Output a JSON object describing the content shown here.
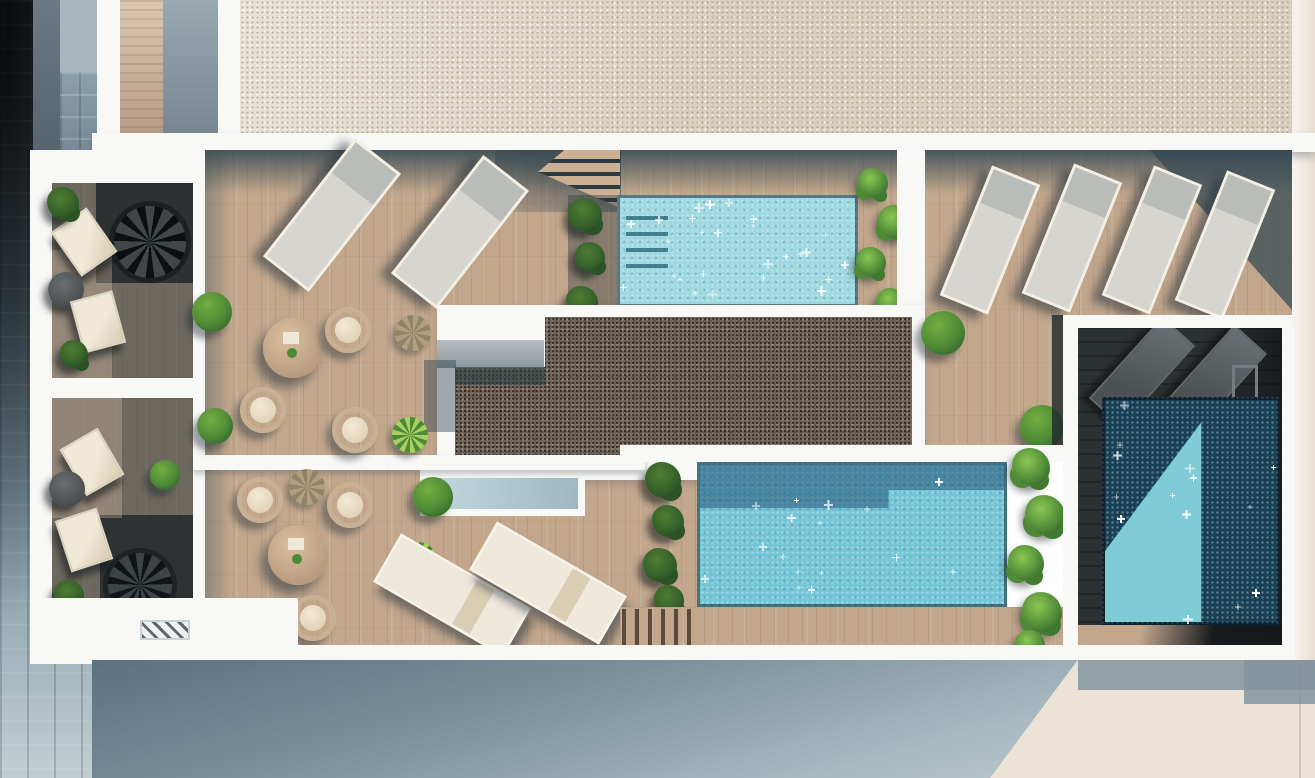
{
  "scene": {
    "type": "aerial-architectural-render",
    "subject": "Rooftop terrace of an apartment building with three swimming pools, wooden decks, sun loungers, lounge alcoves and planting",
    "lighting": "sunny day, hard diagonal shadows cast toward lower-left"
  },
  "palette": {
    "white_wall": "#f8f8f6",
    "gravel_light": "#d9d0c0",
    "gravel_dark": "#6f645a",
    "wood": "#c2a78d",
    "slate_shadow": "#44575f",
    "deck_shadow_dark": "#2c3134",
    "street_dark": "#23282d",
    "street_light": "#c2ced2",
    "facade_top": "#5b7181",
    "facade_bottom": "#c6d1d3",
    "concrete_plaza": "#ebe3d6",
    "plaza_shadow": "#a2b2bc",
    "pool_light": "#9ed8e0",
    "pool_mid": "#74c6d6",
    "pool_shadow_band": "#2f6e96",
    "pool_dark": "#173f55",
    "pool_lit_triangle": "#7fccd6",
    "lounger_gray": "#d6d5d0",
    "frame_white": "#f3efe5",
    "cream": "#ebe5d5",
    "wicker": "#c8b193",
    "plant_bright": "#74ad41",
    "plant_mid": "#4d8a36",
    "plant_dark": "#2d5a28"
  },
  "pools": [
    {
      "name": "top-pool",
      "x": 617,
      "y": 195,
      "w": 241,
      "h": 112,
      "sparkles": 26,
      "feature": "entry steps along left end"
    },
    {
      "name": "main-pool",
      "x": 697,
      "y": 462,
      "w": 310,
      "h": 145,
      "sparkles": 16,
      "feature": "building shadow band along top edge"
    },
    {
      "name": "plunge-pool",
      "x": 1102,
      "y": 397,
      "w": 178,
      "h": 228,
      "sparkles": 14,
      "feature": "mostly in shadow, sunlit triangle lower-left, ladder at top right"
    }
  ],
  "inventory": {
    "gray_sun_loungers_main_deck": 2,
    "gray_sun_loungers_right_terrace": 4,
    "cream_sun_loungers": 2,
    "shadow_area_loungers": 2,
    "alcove_deck_chairs": 4,
    "wicker_chairs": 6,
    "round_dining_tables": 2,
    "alcove_side_tables": 2,
    "spiral_staircases": 2,
    "skylights": 1,
    "vent_grates": 1,
    "pool_ladders": 1,
    "bushes_and_planters": 22
  }
}
